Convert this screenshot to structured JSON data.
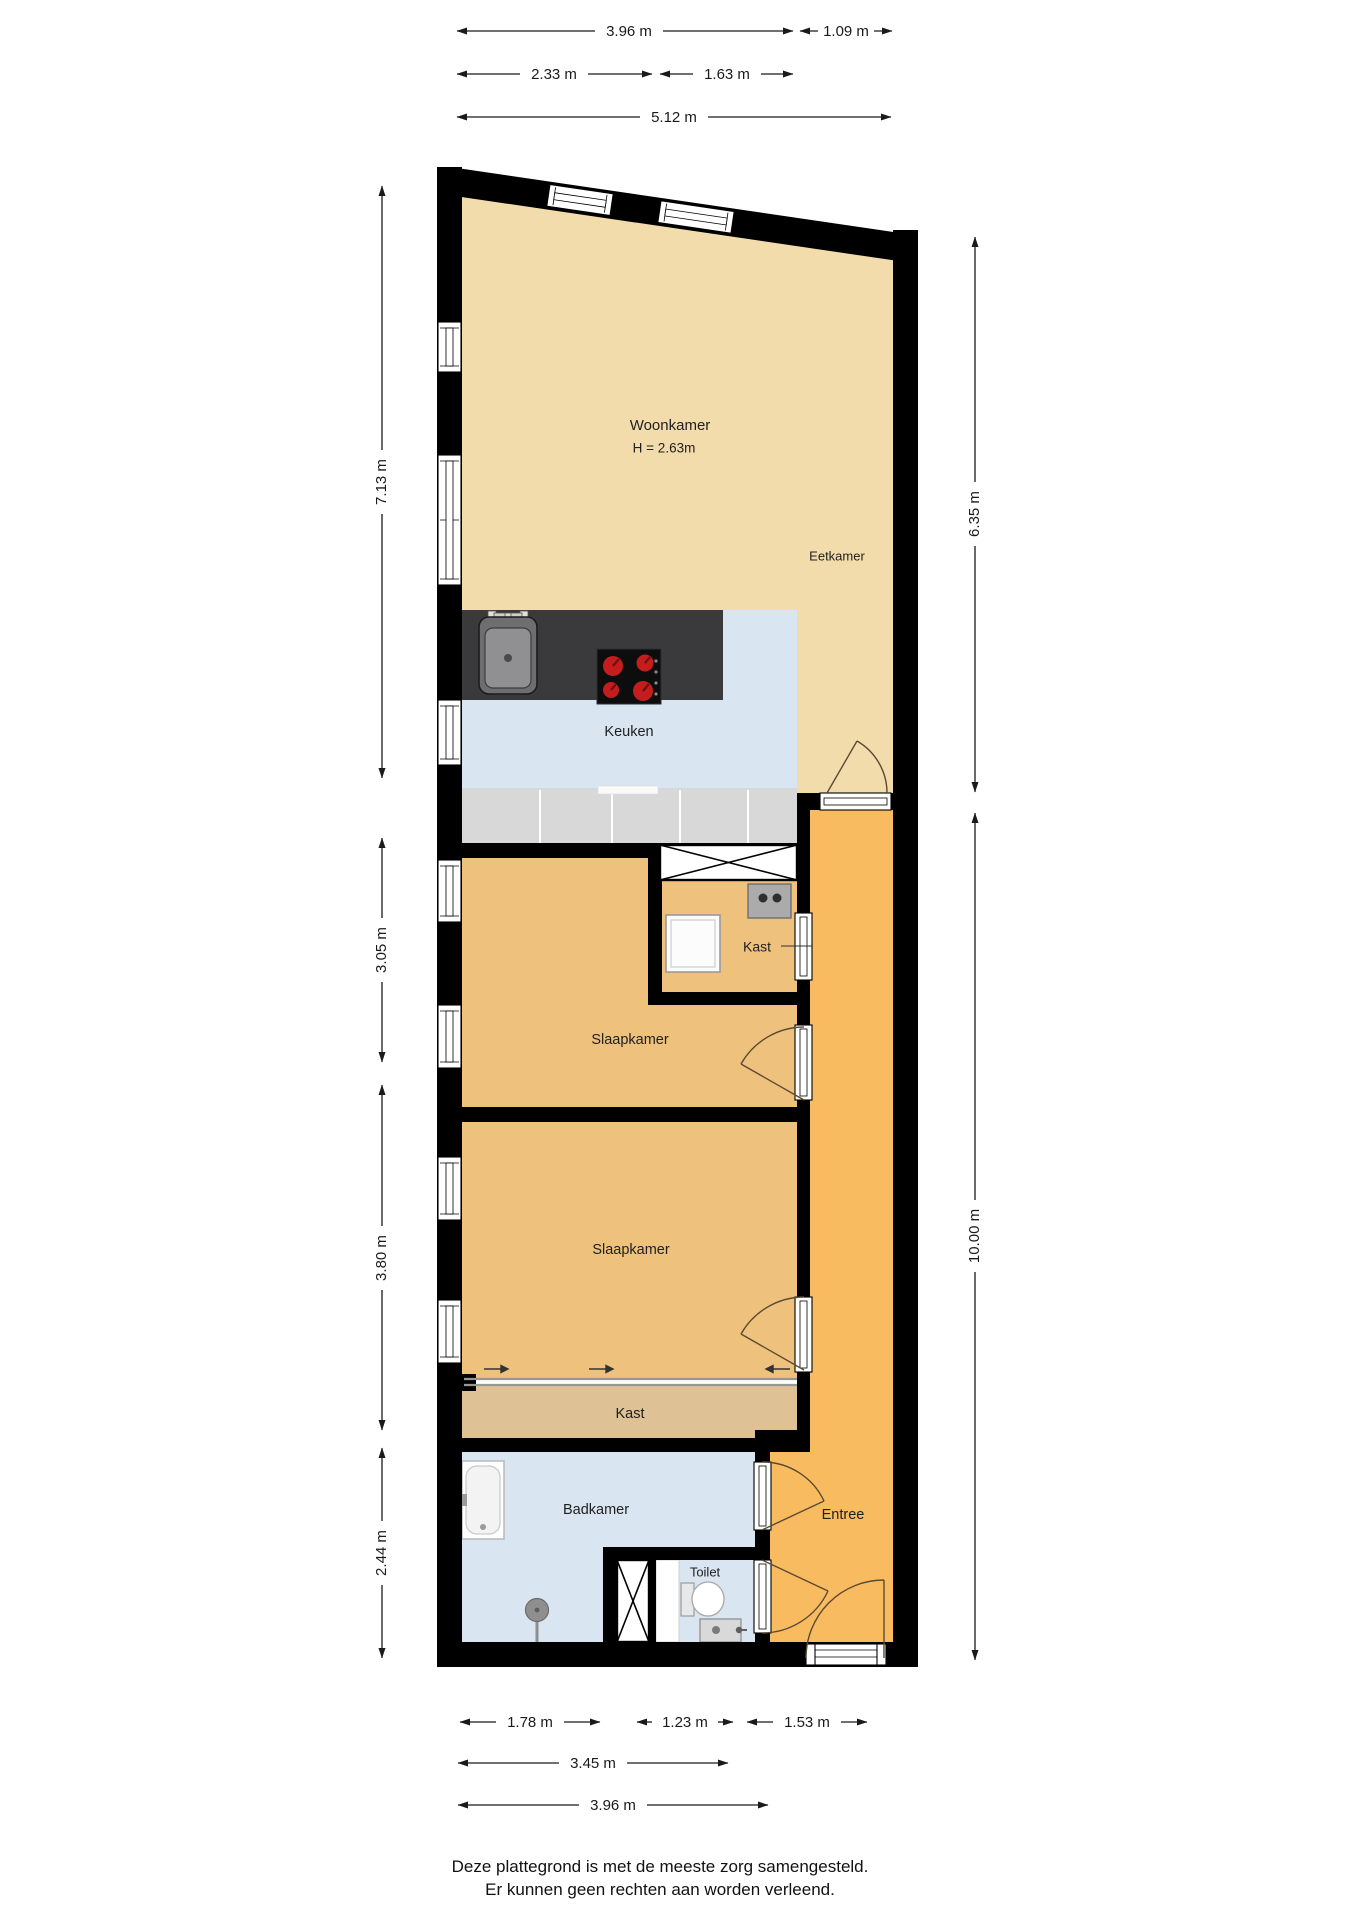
{
  "rooms": {
    "woonkamer": {
      "label": "Woonkamer",
      "height": "H = 2.63m"
    },
    "eetkamer": {
      "label": "Eetkamer"
    },
    "keuken": {
      "label": "Keuken"
    },
    "kast_boiler": {
      "label": "Kast"
    },
    "slaapkamer1": {
      "label": "Slaapkamer"
    },
    "slaapkamer2": {
      "label": "Slaapkamer"
    },
    "kast_wardrobe": {
      "label": "Kast"
    },
    "badkamer": {
      "label": "Badkamer"
    },
    "toilet": {
      "label": "Toilet"
    },
    "entree": {
      "label": "Entree"
    }
  },
  "dimensions": {
    "top_row1_left": "3.96 m",
    "top_row1_right": "1.09 m",
    "top_row2_left": "2.33 m",
    "top_row2_right": "1.63 m",
    "top_row3": "5.12 m",
    "left_1": "7.13 m",
    "left_2": "3.05 m",
    "left_3": "3.80 m",
    "left_4": "2.44 m",
    "right_1": "6.35 m",
    "right_2": "10.00 m",
    "bottom_row1_a": "1.78 m",
    "bottom_row1_b": "1.23 m",
    "bottom_row1_c": "1.53 m",
    "bottom_row2": "3.45 m",
    "bottom_row3": "3.96 m"
  },
  "footer": {
    "line1": "Deze plattegrond is met de meeste zorg samengesteld.",
    "line2": "Er kunnen geen rechten aan worden verleend."
  },
  "colors": {
    "living": "#f2dcab",
    "bedroom": "#eec27d",
    "wardrobe": "#dec194",
    "hall": "#f8bb60",
    "wet": "#d9e5f1",
    "cabinet": "#d8d8d8",
    "counter": "#3a3a3c",
    "wall": "#000000",
    "burner": "#c41d1d"
  }
}
